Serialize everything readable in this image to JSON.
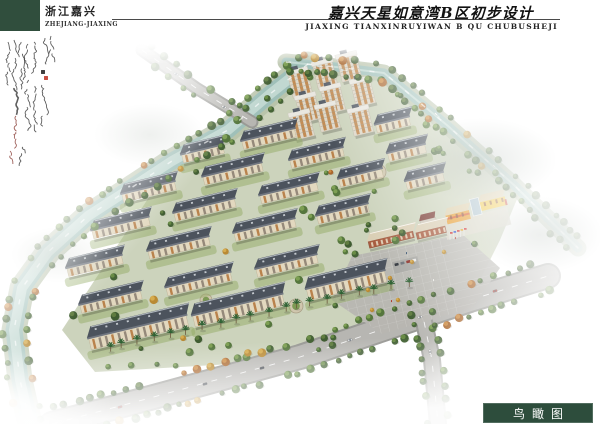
{
  "header": {
    "brand_cn": "浙江嘉兴",
    "brand_en": "ZHEJIANG-JIAXING",
    "title_cn": "嘉兴天星如意湾B区初步设计",
    "title_en": "JIAXING TIANXINRUYIWAN B QU CHUBUSHEJI",
    "brand_block_color": "#304e3d"
  },
  "footer": {
    "label_cn": "鸟瞰图",
    "box_color": "#2d4d3c",
    "text_color": "#ffffff"
  },
  "annotation": {
    "ink_color": "#3a3a3a",
    "red_ink_color": "#8a4038",
    "seal_red": "#c23b2e",
    "seal_dark": "#2a2a2a",
    "columns": [
      [
        8,
        12,
        40,
        0
      ],
      [
        14,
        10,
        46,
        0
      ],
      [
        21,
        12,
        42,
        0
      ],
      [
        28,
        14,
        36,
        0
      ],
      [
        34,
        12,
        30,
        0
      ],
      [
        45,
        8,
        26,
        0
      ],
      [
        51,
        6,
        22,
        0
      ],
      [
        28,
        58,
        40,
        0
      ],
      [
        35,
        56,
        44,
        0
      ],
      [
        42,
        55,
        40,
        0
      ],
      [
        14,
        58,
        26,
        1
      ],
      [
        16,
        86,
        30,
        2
      ],
      [
        22,
        116,
        16,
        0
      ],
      [
        10,
        120,
        12,
        2
      ]
    ],
    "seals": [
      [
        44,
        46,
        1
      ],
      [
        41,
        40,
        0
      ]
    ]
  },
  "scene": {
    "colors": {
      "ground": "#c8cfb6",
      "plaza": "#b7b6b1",
      "bank": "#b7c2a8",
      "water": "#9fc0b9",
      "waterLight": "#c9ddd7",
      "roadDark": "#9a9a96",
      "road": "#b7b6b2",
      "roofDark": "#4c535d",
      "roofRidge": "#b3bac1",
      "facade": "#e2d8bf",
      "facadeEdge": "#b4a586",
      "bay1": "#b5793f",
      "bay2": "#8d8172",
      "eave": "#707680",
      "towerWall": "#ded8ca",
      "towerBay": "#bf8448",
      "towerRoof": "#e9e7e0",
      "lawn": "#93ab66",
      "schoolOrange": "#e59b2e",
      "schoolYellow": "#ecc33f",
      "schoolGlass": "#a9bfca",
      "schoolRoof": "#dbcda8",
      "commWall": "#a85c40",
      "commRoof": "#dacfb5",
      "greens": [
        [
          "#456336",
          "#6d9048"
        ],
        [
          "#55763d",
          "#82a455"
        ],
        [
          "#3f5c31",
          "#637f41"
        ]
      ],
      "autumn": [
        [
          "#b98a34",
          "#d9af52"
        ],
        [
          "#a9662c",
          "#cf8f45"
        ]
      ],
      "palmFrond": "#2f6234",
      "palmTrunk": "#6b573c",
      "carColors": [
        "#f2f2f0",
        "#3a3f46",
        "#b03a30",
        "#dfe3e6"
      ]
    },
    "paths": {
      "river": [
        [
          308,
          64
        ],
        [
          270,
          94
        ],
        [
          228,
          130
        ],
        [
          172,
          161
        ],
        [
          128,
          190
        ],
        [
          88,
          216
        ],
        [
          48,
          252
        ],
        [
          22,
          288
        ],
        [
          14,
          330
        ],
        [
          20,
          380
        ],
        [
          30,
          424
        ]
      ],
      "canal": [
        [
          286,
          62
        ],
        [
          336,
          67
        ],
        [
          384,
          73
        ],
        [
          448,
          126
        ],
        [
          515,
          186
        ],
        [
          578,
          248
        ]
      ],
      "south": [
        [
          52,
          424
        ],
        [
          150,
          398
        ],
        [
          300,
          357
        ],
        [
          470,
          300
        ],
        [
          548,
          276
        ]
      ],
      "bridge": [
        [
          142,
          50
        ],
        [
          196,
          88
        ],
        [
          252,
          122
        ]
      ],
      "branch": [
        [
          421,
          307
        ],
        [
          432,
          360
        ],
        [
          438,
          424
        ]
      ],
      "palms": [
        [
          104,
          352
        ],
        [
          240,
          322
        ],
        [
          372,
          293
        ],
        [
          420,
          283
        ]
      ]
    },
    "water": {
      "riverWidth": 17,
      "canalWidth": 9
    },
    "roadDefs": [
      [
        "south",
        24
      ],
      [
        "bridge",
        11
      ],
      [
        "branch",
        16
      ]
    ],
    "sitePoly": [
      [
        318,
        70
      ],
      [
        392,
        76
      ],
      [
        452,
        130
      ],
      [
        520,
        192
      ],
      [
        500,
        240
      ],
      [
        470,
        300
      ],
      [
        300,
        360
      ],
      [
        95,
        372
      ],
      [
        62,
        330
      ],
      [
        172,
        162
      ],
      [
        252,
        106
      ]
    ],
    "plazaPoly": [
      [
        332,
        300
      ],
      [
        352,
        256
      ],
      [
        462,
        234
      ],
      [
        500,
        268
      ],
      [
        472,
        308
      ],
      [
        382,
        334
      ]
    ],
    "slabs": [
      [
        140,
        338,
        100,
        1
      ],
      [
        240,
        316,
        92,
        1
      ],
      [
        348,
        291,
        80,
        1
      ],
      [
        112,
        306,
        62,
        0
      ],
      [
        200,
        288,
        66,
        0
      ],
      [
        288,
        270,
        62,
        0
      ],
      [
        96,
        270,
        56,
        0
      ],
      [
        180,
        252,
        62,
        0
      ],
      [
        266,
        234,
        62,
        0
      ],
      [
        344,
        218,
        52,
        0
      ],
      [
        122,
        232,
        58,
        0
      ],
      [
        206,
        214,
        62,
        0
      ],
      [
        290,
        197,
        58,
        0
      ],
      [
        362,
        182,
        44,
        0
      ],
      [
        150,
        196,
        54,
        0
      ],
      [
        234,
        178,
        60,
        0
      ],
      [
        318,
        162,
        54,
        0
      ],
      [
        204,
        158,
        42,
        0
      ],
      [
        270,
        143,
        54,
        0
      ],
      [
        394,
        129,
        34,
        0
      ],
      [
        408,
        157,
        38,
        0
      ],
      [
        426,
        185,
        38,
        0
      ]
    ],
    "towers": [
      [
        303,
        96
      ],
      [
        328,
        87
      ],
      [
        352,
        80
      ],
      [
        311,
        121
      ],
      [
        336,
        112
      ],
      [
        366,
        105
      ],
      [
        305,
        138
      ],
      [
        331,
        130
      ],
      [
        364,
        134
      ]
    ],
    "commercial": [
      [
        392,
        243,
        46
      ],
      [
        432,
        236,
        30
      ]
    ],
    "school": {
      "x": 478,
      "y": 214
    },
    "redRoof": {
      "x": 429,
      "y": 224
    },
    "circles": [
      [
        378,
        172,
        8
      ],
      [
        296,
        306,
        7
      ],
      [
        206,
        300,
        6
      ]
    ],
    "flags": {
      "x": 450,
      "y": 240
    },
    "parking": {
      "x": 406,
      "y": 265
    },
    "boats": [
      [
        318,
        66,
        8
      ],
      [
        342,
        70,
        8
      ],
      [
        436,
        114,
        42
      ],
      [
        494,
        166,
        42
      ]
    ],
    "cars": [
      [
        120,
        407,
        -16
      ],
      [
        205,
        384,
        -15
      ],
      [
        262,
        368,
        -16
      ],
      [
        350,
        340,
        -18
      ],
      [
        420,
        317,
        -18
      ],
      [
        495,
        291,
        -17
      ],
      [
        176,
        74,
        33
      ],
      [
        224,
        107,
        33
      ],
      [
        430,
        352,
        81
      ]
    ],
    "people": [
      [
        455,
        237
      ],
      [
        471,
        243
      ],
      [
        433,
        279
      ],
      [
        391,
        300
      ],
      [
        406,
        252
      ]
    ],
    "shrubs": [
      [
        368,
        290
      ],
      [
        390,
        278
      ],
      [
        412,
        262
      ],
      [
        444,
        252
      ],
      [
        372,
        310
      ],
      [
        398,
        300
      ]
    ],
    "treeLines": [
      [
        "river",
        11,
        12
      ],
      [
        "river",
        -12,
        14
      ],
      [
        "canal",
        8,
        10
      ],
      [
        "canal",
        -8,
        12
      ],
      [
        "south",
        15,
        12
      ],
      [
        "south",
        -15,
        13
      ],
      [
        "bridge",
        7.5,
        14
      ],
      [
        "bridge",
        -7.5,
        15
      ],
      [
        "branch",
        10,
        13
      ],
      [
        "branch",
        -10,
        14
      ]
    ],
    "palmSpacing": 14,
    "scatter": {
      "count": 58,
      "seed": 13
    }
  }
}
